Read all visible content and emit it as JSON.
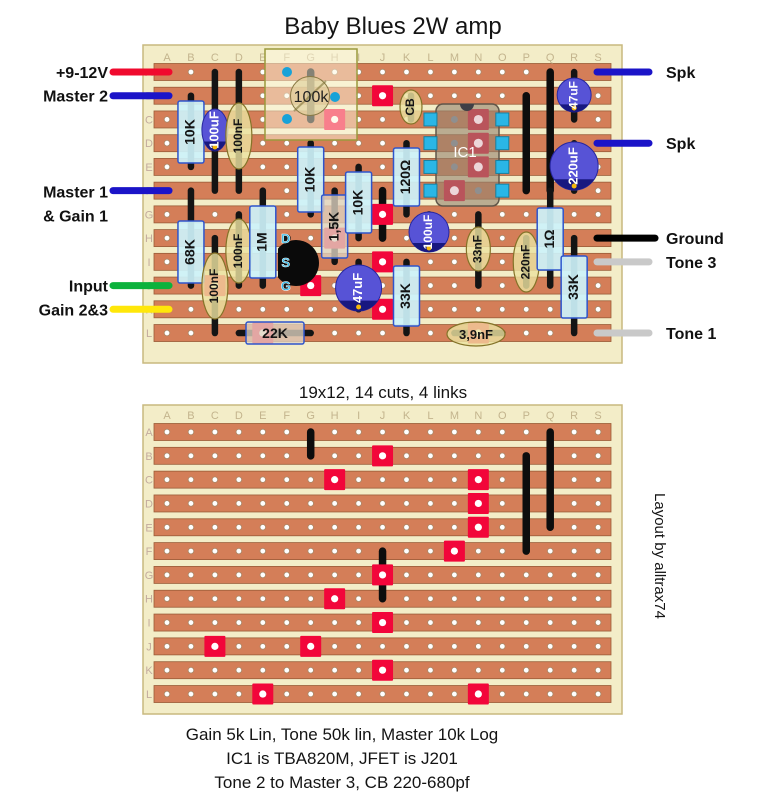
{
  "title": "Baby Blues 2W amp",
  "between_caption": "19x12, 14 cuts, 4 links",
  "credit": "Layout by alltrax74",
  "notes": [
    "Gain 5k Lin, Tone 50k lin, Master 10k Log",
    "IC1 is TBA820M, JFET is J201",
    "Tone 2 to Master 3, CB 220-680pf"
  ],
  "grid": {
    "columns": [
      "A",
      "B",
      "C",
      "D",
      "E",
      "F",
      "G",
      "H",
      "I",
      "J",
      "K",
      "L",
      "M",
      "N",
      "O",
      "P",
      "Q",
      "R",
      "S"
    ],
    "rows": [
      "A",
      "B",
      "C",
      "D",
      "E",
      "F",
      "G",
      "H",
      "I",
      "J",
      "K",
      "L"
    ]
  },
  "colors": {
    "board": "#f3edc8",
    "board_edge": "#c8b97f",
    "strip": "#d47e58",
    "strip_edge": "#9a5c38",
    "hole_ring": "#a98868",
    "cut": "#f2063a",
    "link": "#0d0d0d",
    "lead": "#141414",
    "resistor_cyan": "#cdf2fa",
    "resistor_tan": "#dfd4c1",
    "resistor_edge": "#2f55cc",
    "film": "#ebe2a0",
    "film_edge": "#847328",
    "ecap": "#5753d6",
    "ecap_dark": "#181880",
    "ecap_mark": "#f5b80a",
    "pad_cyan": "#2ab6e6",
    "ic_body": "#968470",
    "pin_gray": "#8f8f8f",
    "pin_pink": "#ecd6d9",
    "jfet_label": "#2cb8e8",
    "col_letter": "#c3b48d",
    "row_letter": "#c3ab9e"
  },
  "cuts": [
    [
      "J",
      "B"
    ],
    [
      "H",
      "C"
    ],
    [
      "N",
      "C"
    ],
    [
      "N",
      "D"
    ],
    [
      "N",
      "E"
    ],
    [
      "M",
      "F"
    ],
    [
      "J",
      "G"
    ],
    [
      "H",
      "H"
    ],
    [
      "J",
      "I"
    ],
    [
      "C",
      "J"
    ],
    [
      "G",
      "J"
    ],
    [
      "J",
      "K"
    ],
    [
      "E",
      "L"
    ],
    [
      "N",
      "L"
    ]
  ],
  "top_board": {
    "wires_left": [
      {
        "lines": [
          "+9-12V"
        ],
        "row": "A",
        "color": "#f00a2e"
      },
      {
        "lines": [
          "Master 2"
        ],
        "row": "B",
        "color": "#1b14c8"
      },
      {
        "lines": [
          "Master 1",
          "& Gain 1"
        ],
        "row": "F",
        "color": "#1b14c8"
      },
      {
        "lines": [
          "Input"
        ],
        "row": "J",
        "color": "#0cb23c"
      },
      {
        "lines": [
          "Gain 2&3"
        ],
        "row": "K",
        "color": "#ffe70a"
      }
    ],
    "wires_right": [
      {
        "lines": [
          "Spk"
        ],
        "row": "A",
        "color": "#1b14c8"
      },
      {
        "lines": [
          "Spk"
        ],
        "row": "D",
        "color": "#1b14c8"
      },
      {
        "lines": [
          "Ground"
        ],
        "row": "H",
        "color": "#000000"
      },
      {
        "lines": [
          "Tone 3"
        ],
        "row": "I",
        "color": "#c9c9c9"
      },
      {
        "lines": [
          "Tone 1"
        ],
        "row": "L",
        "color": "#c9c9c9"
      }
    ],
    "links": [
      [
        "G",
        "A",
        "C"
      ],
      [
        "J",
        "F",
        "H"
      ],
      [
        "P",
        "B",
        "F"
      ],
      [
        "Q",
        "A",
        "F"
      ]
    ],
    "components": [
      {
        "type": "resistor",
        "style": "cyan",
        "label": "10K",
        "col": "B",
        "lead": [
          "B",
          "E"
        ],
        "body": [
          101,
          163
        ]
      },
      {
        "type": "resistor",
        "style": "cyan",
        "label": "68K",
        "col": "B",
        "lead": [
          "F",
          "J"
        ],
        "body": [
          221,
          283
        ]
      },
      {
        "type": "ecap",
        "label": "100uF",
        "col": "C",
        "lead": [
          "A",
          "F"
        ],
        "cy": 130,
        "rx": 13,
        "ry": 21
      },
      {
        "type": "film",
        "label": "100nF",
        "col": "C",
        "lead": [
          "H",
          "L"
        ],
        "cy": 286,
        "rx": 13,
        "ry": 33
      },
      {
        "type": "film",
        "label": "100nF",
        "col": "D",
        "lead": [
          "A",
          "F"
        ],
        "cy": 136,
        "rx": 13,
        "ry": 33
      },
      {
        "type": "film",
        "label": "100nF",
        "col": "D",
        "lead": [
          "G",
          "J"
        ],
        "cy": 251,
        "rx": 13,
        "ry": 32
      },
      {
        "type": "resistor",
        "style": "cyan",
        "label": "1M",
        "col": "E",
        "lead": [
          "F",
          "J"
        ],
        "body": [
          206,
          278
        ]
      },
      {
        "type": "resistor_h",
        "style": "tan",
        "label": "22K",
        "row": "L",
        "lead": [
          "D",
          "G"
        ],
        "body": [
          246,
          304
        ]
      },
      {
        "type": "jfet",
        "labels": [
          "D",
          "S",
          "G"
        ],
        "col": "F",
        "rows": [
          "H",
          "I",
          "J"
        ],
        "cx": 296,
        "cy": 263,
        "r": 23
      },
      {
        "type": "resistor",
        "style": "cyan",
        "label": "10K",
        "col": "G",
        "lead": [
          "D",
          "G"
        ],
        "body": [
          147,
          212
        ]
      },
      {
        "type": "resistor",
        "style": "tan",
        "label": "1,5K",
        "col": "H",
        "lead": [
          "F",
          "I"
        ],
        "body": [
          195,
          258
        ]
      },
      {
        "type": "resistor",
        "style": "cyan",
        "label": "10K",
        "col": "I",
        "lead": [
          "E",
          "H"
        ],
        "body": [
          172,
          233
        ]
      },
      {
        "type": "ecap",
        "label": "47uF",
        "col": "I",
        "lead": [
          "I",
          "K"
        ],
        "cy": 288,
        "rx": 23,
        "ry": 23
      },
      {
        "type": "film",
        "label": "CB",
        "col": "K",
        "lead": [
          "B",
          "C"
        ],
        "cx": 411,
        "cy": 107,
        "rx": 11,
        "ry": 17
      },
      {
        "type": "resistor",
        "style": "cyan",
        "label": "120Ω",
        "col": "K",
        "lead": [
          "D",
          "G"
        ],
        "body": [
          148,
          206
        ]
      },
      {
        "type": "ecap",
        "label": "100uF",
        "col": "L",
        "lead": [
          "G",
          "H"
        ],
        "cx": 429,
        "cy": 232,
        "rx": 20,
        "ry": 20
      },
      {
        "type": "resistor",
        "style": "cyan",
        "label": "33K",
        "col": "K",
        "lead": [
          "I",
          "L"
        ],
        "body": [
          266,
          326
        ]
      },
      {
        "type": "film",
        "label": "33nF",
        "col": "N",
        "lead": [
          "G",
          "J"
        ],
        "cy": 249,
        "rx": 12,
        "ry": 22
      },
      {
        "type": "film_h",
        "label": "3,9nF",
        "row": "L",
        "lead": [
          "M",
          "O"
        ],
        "cx": 476,
        "cy": 334,
        "rx": 29,
        "ry": 12
      },
      {
        "type": "film",
        "label": "220nF",
        "col": "P",
        "lead": [
          "H",
          "J"
        ],
        "cy": 262,
        "rx": 13,
        "ry": 30
      },
      {
        "type": "resistor",
        "style": "cyan",
        "label": "1Ω",
        "col": "Q",
        "lead": [
          "F",
          "J"
        ],
        "body": [
          208,
          270
        ]
      },
      {
        "type": "ecap",
        "label": "47uF",
        "col": "R",
        "lead": [
          "A",
          "C"
        ],
        "cy": 95,
        "rx": 17,
        "ry": 17
      },
      {
        "type": "ecap",
        "label": "220uF",
        "col": "R",
        "lead": [
          "D",
          "F"
        ],
        "cy": 166,
        "rx": 24,
        "ry": 24
      },
      {
        "type": "resistor",
        "style": "cyan",
        "label": "33K",
        "col": "R",
        "lead": [
          "H",
          "L"
        ],
        "body": [
          256,
          318
        ]
      },
      {
        "type": "pot",
        "label": "100k",
        "rect": [
          265,
          49,
          92,
          91
        ],
        "circle": [
          310,
          96,
          19.5
        ],
        "lugs": [
          [
            287,
            72
          ],
          [
            335,
            97
          ],
          [
            287,
            119
          ]
        ]
      },
      {
        "type": "ic",
        "label": "IC1",
        "rect": [
          436,
          104,
          63,
          102
        ],
        "notch": [
          467,
          104
        ],
        "pads_cols": [
          "L",
          "O"
        ],
        "pads_rows": [
          "C",
          "D",
          "E",
          "F"
        ],
        "pins_gray": [
          [
            "M",
            "C"
          ],
          [
            "M",
            "D"
          ],
          [
            "M",
            "E"
          ],
          [
            "N",
            "F"
          ]
        ],
        "pins_pink": [
          [
            "N",
            "C"
          ],
          [
            "N",
            "D"
          ],
          [
            "N",
            "E"
          ],
          [
            "M",
            "F"
          ]
        ],
        "label_pos": [
          465,
          152
        ]
      }
    ]
  },
  "bottom_board": {
    "links": [
      [
        "G",
        "A",
        "B"
      ],
      [
        "J",
        "F",
        "H"
      ],
      [
        "P",
        "B",
        "F"
      ],
      [
        "Q",
        "A",
        "E"
      ]
    ]
  }
}
